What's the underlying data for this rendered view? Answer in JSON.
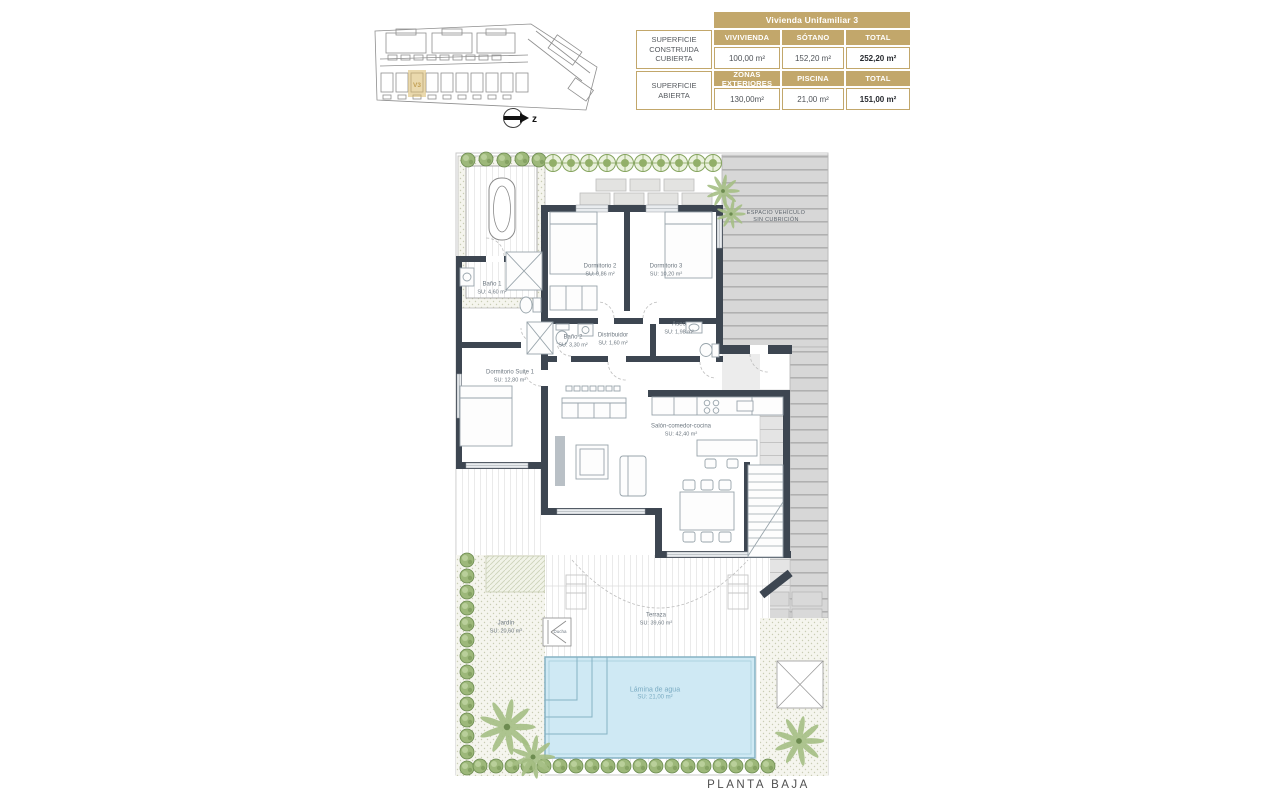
{
  "site_plan": {
    "highlighted_unit": "V3",
    "north_label": "z"
  },
  "summary_table": {
    "title": "Vivienda Unifamiliar 3",
    "groups": [
      {
        "label": "SUPERFICIE CONSTRUIDA CUBIERTA",
        "headers": [
          "VIVIVIENDA",
          "SÓTANO",
          "TOTAL"
        ],
        "values": [
          "100,00 m²",
          "152,20 m²",
          "252,20 m²"
        ]
      },
      {
        "label": "SUPERFICIE ABIERTA",
        "headers": [
          "ZONAS EXTERIORES",
          "PISCINA",
          "TOTAL"
        ],
        "values": [
          "130,00m²",
          "21,00 m²",
          "151,00 m²"
        ]
      }
    ]
  },
  "floor_plan": {
    "caption": "PLANTA BAJA",
    "rooms": [
      {
        "name": "Baño 1",
        "area": "SU: 4,60 m²"
      },
      {
        "name": "Dormitorio 2",
        "area": "SU: 9,86 m²"
      },
      {
        "name": "Dormitorio 3",
        "area": "SU: 10,20 m²"
      },
      {
        "name": "Baño 2",
        "area": "SU: 3,30 m²"
      },
      {
        "name": "Distribuidor",
        "area": "SU: 1,60 m²"
      },
      {
        "name": "Aseo",
        "area": "SU: 1,98 m²"
      },
      {
        "name": "Dormitorio Suite 1",
        "area": "SU: 12,80 m²"
      },
      {
        "name": "Salón-comedor-cocina",
        "area": "SU: 42,40 m²"
      },
      {
        "name": "Terraza",
        "area": "SU: 39,60 m²"
      },
      {
        "name": "Jardín",
        "area": "SU: 20,60 m²"
      },
      {
        "name": "Ducha",
        "area": ""
      },
      {
        "name": "Lámina de agua",
        "area": "SU: 21,00 m²"
      },
      {
        "name": "ESPACIO VEHÍCULO",
        "area": "SIN CUBRICIÓN"
      }
    ],
    "colors": {
      "wall": "#3d4651",
      "pool": "#cfe9f4",
      "accent_gold": "#c2a76b",
      "vegetation": "#8fae6d"
    }
  }
}
